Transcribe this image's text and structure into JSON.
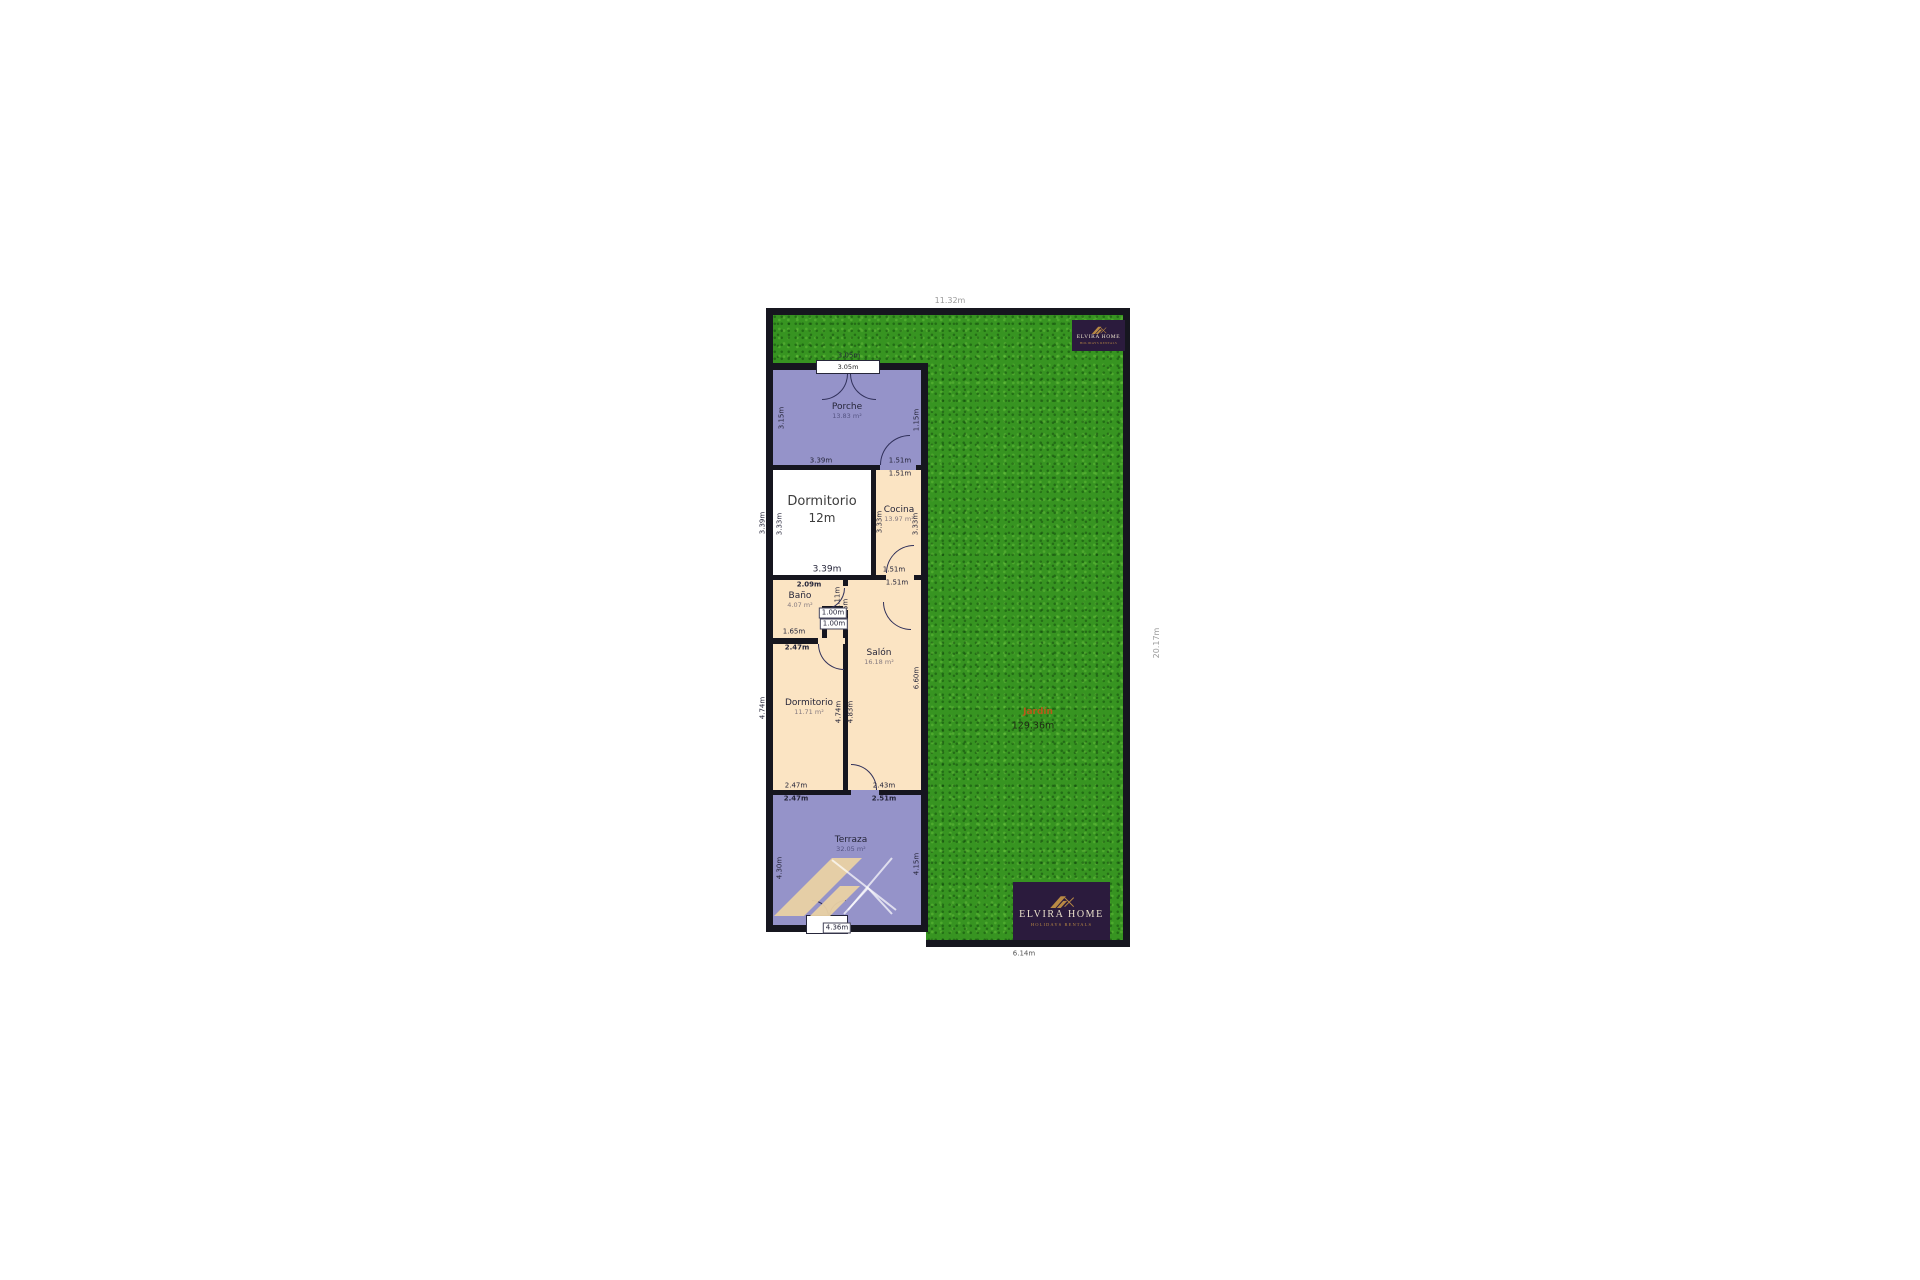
{
  "branding": {
    "name": "ELVIRA HOME",
    "tagline": "HOLIDAYS RENTALS"
  },
  "outer_dimensions": {
    "top_width": "11.32m",
    "right_height": "20.17m",
    "bottom_width": "6.14m"
  },
  "garden": {
    "name": "Jardín",
    "area": "129.36m"
  },
  "rooms": {
    "porche": {
      "name": "Porche",
      "area": "13.83 m²",
      "door_width": "3.05m",
      "door_width_outer": "3.05m",
      "left": "3.15m",
      "right": "1.15m",
      "bottom_left": "3.39m",
      "bottom_right": "1.51m"
    },
    "dormitorio1": {
      "name": "Dormitorio",
      "size": "12m",
      "left_outer": "3.39m",
      "left_inner": "3.33m",
      "bottom": "3.39m"
    },
    "cocina": {
      "name": "Cocina",
      "area": "13.97 m²",
      "top": "1.51m",
      "left": "3.33m",
      "right": "3.33m",
      "bottom": "1.51m"
    },
    "bano": {
      "name": "Baño",
      "area": "4.07 m²",
      "top": "2.09m",
      "notch_width": "1.00m",
      "notch_height": "1.00m",
      "door_side_upper": "1.11m",
      "door_side_lower": "1.36m",
      "bottom": "1.65m",
      "bottom_outer": "2.47m"
    },
    "salon": {
      "name": "Salón",
      "area": "16.18 m²",
      "top": "1.51m",
      "right": "6.60m",
      "divider_left": "4.74m",
      "divider_right": "4.83m",
      "bottom": "2.43m",
      "bottom_outer": "2.51m"
    },
    "dormitorio2": {
      "name": "Dormitorio",
      "area": "11.71 m²",
      "left": "4.74m",
      "bottom": "2.47m",
      "bottom_outer": "2.47m"
    },
    "terraza": {
      "name": "Terraza",
      "area": "32.05 m²",
      "left": "4.30m",
      "right": "4.15m",
      "door_width": "4.36m"
    }
  },
  "colors": {
    "garden": "#379421",
    "wall": "#16161f",
    "lavender": "#9593c9",
    "cream": "#fbe4c3",
    "white_room": "#ffffff",
    "logo_bg": "#2b1b3d",
    "logo_gold": "#b98a44",
    "garden_label": "#b85a1a",
    "watermark": "#e9d1a4"
  }
}
